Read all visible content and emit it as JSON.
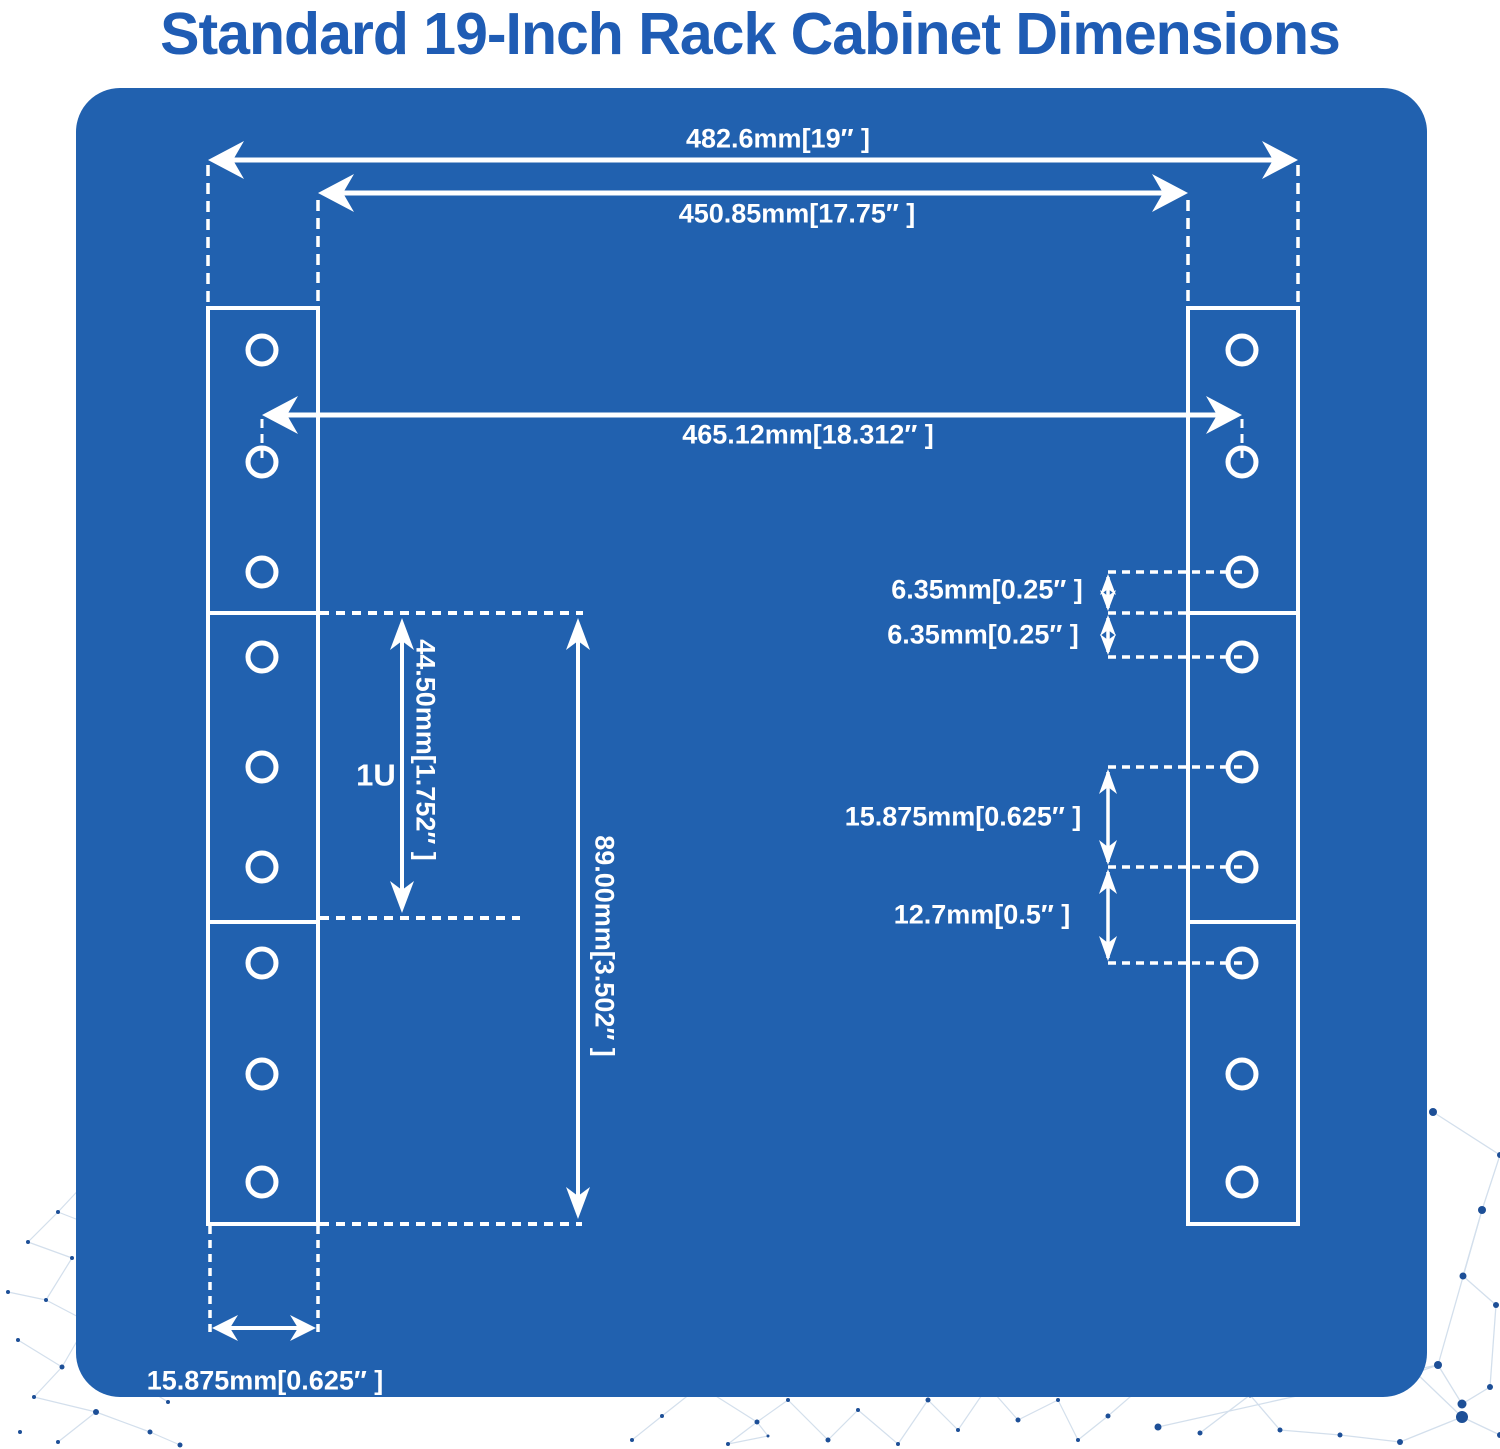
{
  "title": "Standard 19-Inch Rack Cabinet Dimensions",
  "colors": {
    "panel_blue": "#2161af",
    "title_blue": "#1f5cb4",
    "diagram_white": "#ffffff",
    "constellation_dot": "#1d4f97",
    "constellation_line": "#d3dfec"
  },
  "labels": {
    "overall_width": "482.6mm[19″ ]",
    "inner_width": "450.85mm[17.75″ ]",
    "hole_center_span": "465.12mm[18.312″ ]",
    "edge_offset_upper": "6.35mm[0.25″ ]",
    "edge_offset_lower": "6.35mm[0.25″ ]",
    "hole_pitch_wide": "15.875mm[0.625″ ]",
    "hole_pitch_narrow": "12.7mm[0.5″ ]",
    "unit_height": "44.50mm[1.752″ ]",
    "unit_symbol": "1U",
    "double_unit_height": "89.00mm[3.502″ ]",
    "flange_width": "15.875mm[0.625″ ]"
  }
}
